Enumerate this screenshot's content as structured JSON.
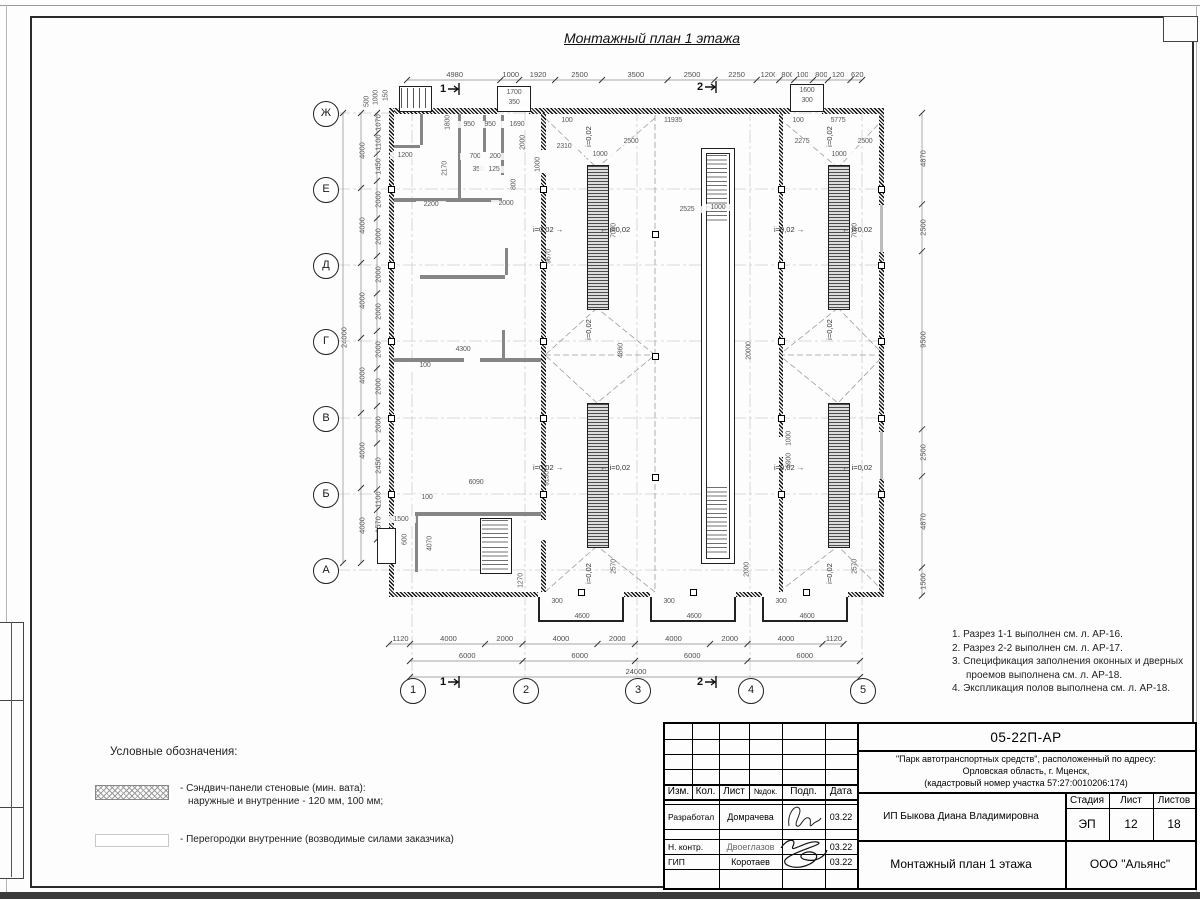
{
  "sheet": {
    "title": "Монтажный план 1 этажа"
  },
  "axes": {
    "rows": [
      "Ж",
      "Е",
      "Д",
      "Г",
      "В",
      "Б",
      "А"
    ],
    "cols": [
      "1",
      "2",
      "3",
      "4",
      "5"
    ]
  },
  "chains": [
    {
      "o": "h",
      "y": 80,
      "start": 407,
      "vals": [
        4980,
        1000,
        1920,
        2500,
        3500,
        2500,
        2250,
        1200,
        800,
        1000,
        800,
        1200,
        620
      ]
    },
    {
      "o": "h",
      "y": 644,
      "start": 389,
      "vals": [
        1120,
        4000,
        2000,
        4000,
        2000,
        4000,
        2000,
        4000,
        1120
      ]
    },
    {
      "o": "h",
      "y": 661,
      "start": 410,
      "vals": [
        6000,
        6000,
        6000,
        6000
      ]
    },
    {
      "o": "h",
      "y": 677,
      "start": 410,
      "vals": [
        24000
      ]
    },
    {
      "o": "v",
      "x": 361,
      "start": 113,
      "vals": [
        4000,
        4000,
        4000,
        4000,
        4000,
        4000
      ]
    },
    {
      "o": "v",
      "x": 343,
      "start": 113,
      "vals": [
        24000
      ]
    },
    {
      "o": "v",
      "x": 922,
      "start": 113,
      "vals": [
        4870,
        2500,
        9500,
        2500,
        4870,
        1500
      ]
    },
    {
      "o": "v",
      "x": 377,
      "start": 113,
      "vals": [
        1070,
        1100,
        1450,
        2000,
        2000,
        2000,
        2000,
        2000,
        2000,
        2000,
        2450,
        1100,
        1570
      ]
    }
  ],
  "plan_dims": [
    [
      "11935",
      672,
      122,
      0
    ],
    [
      "100",
      566,
      122,
      0
    ],
    [
      "5775",
      837,
      122,
      0
    ],
    [
      "100",
      797,
      122,
      0
    ],
    [
      "950",
      468,
      126,
      0
    ],
    [
      "950",
      489,
      126,
      0
    ],
    [
      "1690",
      516,
      126,
      0
    ],
    [
      "700",
      474,
      158,
      0
    ],
    [
      "200",
      494,
      158,
      0
    ],
    [
      "350",
      477,
      171,
      0
    ],
    [
      "125",
      493,
      171,
      0
    ],
    [
      "2200",
      430,
      206,
      0
    ],
    [
      "2000",
      505,
      205,
      0
    ],
    [
      "2310",
      563,
      148,
      0
    ],
    [
      "2500",
      630,
      143,
      0
    ],
    [
      "1000",
      599,
      156,
      0
    ],
    [
      "2275",
      801,
      143,
      0
    ],
    [
      "2500",
      864,
      143,
      0
    ],
    [
      "1000",
      838,
      156,
      0
    ],
    [
      "2525",
      686,
      211,
      0
    ],
    [
      "1000",
      717,
      209,
      0
    ],
    [
      "4300",
      462,
      351,
      0
    ],
    [
      "100",
      424,
      367,
      0
    ],
    [
      "6090",
      475,
      484,
      0
    ],
    [
      "100",
      426,
      499,
      0
    ],
    [
      "1500",
      400,
      521,
      0
    ],
    [
      "300",
      556,
      603,
      0
    ],
    [
      "300",
      668,
      603,
      0
    ],
    [
      "300",
      780,
      603,
      0
    ],
    [
      "4600",
      581,
      618,
      0
    ],
    [
      "4600",
      693,
      618,
      0
    ],
    [
      "4600",
      806,
      618,
      0
    ],
    [
      "1700",
      513,
      94,
      0
    ],
    [
      "350",
      513,
      104,
      0
    ],
    [
      "1600",
      806,
      92,
      0
    ],
    [
      "300",
      806,
      102,
      0
    ],
    [
      "1200",
      404,
      157,
      0
    ],
    [
      "1800",
      447,
      124,
      1
    ],
    [
      "2170",
      444,
      170,
      1
    ],
    [
      "2000",
      522,
      144,
      1
    ],
    [
      "1000",
      537,
      166,
      1
    ],
    [
      "800",
      513,
      186,
      1
    ],
    [
      "7000",
      613,
      232,
      1
    ],
    [
      "7000",
      854,
      232,
      1
    ],
    [
      "9670",
      548,
      258,
      1
    ],
    [
      "20000",
      748,
      352,
      1
    ],
    [
      "4860",
      620,
      352,
      1
    ],
    [
      "6900",
      788,
      462,
      1
    ],
    [
      "1000",
      788,
      440,
      1
    ],
    [
      "2000",
      746,
      571,
      1
    ],
    [
      "2570",
      613,
      568,
      1
    ],
    [
      "2570",
      854,
      568,
      1
    ],
    [
      "9130",
      546,
      480,
      1
    ],
    [
      "4070",
      429,
      545,
      1
    ],
    [
      "1270",
      520,
      582,
      1
    ],
    [
      "600",
      404,
      541,
      1
    ],
    [
      "500",
      366,
      103,
      1
    ],
    [
      "1000",
      375,
      99,
      1
    ],
    [
      "150",
      385,
      97,
      1
    ]
  ],
  "slope": {
    "text": "i=0,02",
    "horiz": [
      {
        "x": 551,
        "y": 230,
        "side": "r"
      },
      {
        "x": 618,
        "y": 230,
        "side": "l"
      },
      {
        "x": 551,
        "y": 468,
        "side": "r"
      },
      {
        "x": 618,
        "y": 468,
        "side": "l"
      },
      {
        "x": 792,
        "y": 230,
        "side": "r"
      },
      {
        "x": 860,
        "y": 230,
        "side": "l"
      },
      {
        "x": 792,
        "y": 468,
        "side": "r"
      },
      {
        "x": 860,
        "y": 468,
        "side": "l"
      }
    ],
    "rot": [
      {
        "x": 592,
        "y": 137
      },
      {
        "x": 833,
        "y": 137
      },
      {
        "x": 592,
        "y": 330
      },
      {
        "x": 833,
        "y": 330
      },
      {
        "x": 592,
        "y": 574
      },
      {
        "x": 833,
        "y": 574
      }
    ]
  },
  "section_marks": [
    {
      "t": "1",
      "x": 440,
      "y": 89
    },
    {
      "t": "1",
      "x": 440,
      "y": 682
    },
    {
      "t": "2",
      "x": 697,
      "y": 87
    },
    {
      "t": "2",
      "x": 697,
      "y": 682
    }
  ],
  "notes": {
    "lines": [
      "1. Разрез 1-1 выполнен см. л. АР-16.",
      "2. Разрез 2-2 выполнен см. л. АР-17.",
      "3. Спецификация заполнения оконных и дверных",
      "проемов выполнена см. л. АР-18.",
      "4. Экспликация полов выполнена см. л. АР-18."
    ]
  },
  "legend": {
    "title": "Условные обозначения:",
    "items": [
      {
        "lines": [
          "- Сэндвич-панели стеновые (мин. вата):",
          "наружные и внутренние - 120 мм, 100 мм;"
        ]
      },
      {
        "lines": [
          "- Перегородки внутренние (возводимые силами заказчика)"
        ]
      }
    ]
  },
  "stamp": {
    "doc_code": "05-22П-АР",
    "project": [
      "\"Парк автотранспортных средств\",  расположенный по адресу:",
      "Орловская область, г. Мценск,",
      "(кадастровый номер участка 57:27:0010206:174)"
    ],
    "cols": {
      "izm": "Изм.",
      "kol": "Кол.",
      "list": "Лист",
      "ndok": "№док.",
      "podp": "Подп.",
      "data": "Дата"
    },
    "rows": [
      {
        "role": "Разработал",
        "name": "Домрачева",
        "date": "03.22"
      },
      {
        "role": "Н. контр.",
        "name": "Двоеглазов",
        "date": "03.22"
      },
      {
        "role": "ГИП",
        "name": "Коротаев",
        "date": "03.22"
      }
    ],
    "stage_label": "Стадия",
    "stage": "ЭП",
    "sheet_label": "Лист",
    "sheet_no": "12",
    "sheets_label": "Листов",
    "sheets_total": "18",
    "client": "ИП Быкова Диана Владимировна",
    "drawing_title": "Монтажный план 1 этажа",
    "org": "ООО \"Альянс\""
  }
}
